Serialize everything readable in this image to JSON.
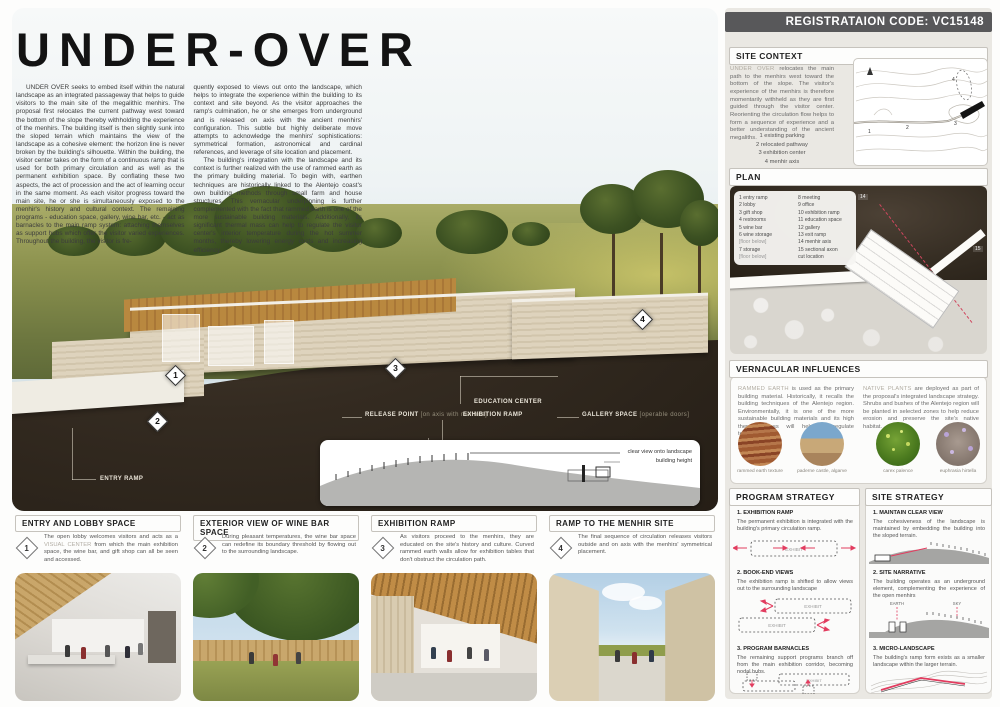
{
  "header": {
    "registration_code": "REGISTRATAION CODE: VC15148"
  },
  "title": "UNDER-OVER",
  "intro": {
    "col1": "UNDER OVER seeks to embed itself within the natural landscape as an integrated passageway that helps to guide visitors to the main site of the megalithic menhirs.  The proposal first relocates the current pathway west toward the bottom of the slope thereby withholding the experience of the menhirs.  The building itself is then slightly sunk into the sloped terrain which maintains the view of the landscape as a cohesive element: the horizon line is never broken by the building's silhouette.   Within the building, the visitor center takes on the form of a continuous ramp that is used for both primary circulation and as well as the permanent exhibition space.  By conflating these two aspects, the act of procession and the act of learning occur in the same moment.  As each visitor progress toward the main site, he or she is simultaneously exposed to the menhir's history and cultural context.  The remaining programs - education space, gallery, wine bar, etc. - act as barnacles to the main ramp system: attaching themselves as support hubs which offer the visitor varied experiences.   Throughout the building, the visitor is fre-",
    "col2_p1": "quently exposed to views out onto the landscape, which helps to integrate the experience within the building to its context and site beyond.   As the visitor approaches the ramp's culmination, he or she emerges from underground and is released on axis with the ancient menhirs' configuration.  This subtle but highly deliberate move attempts to acknowledge the menhirs' sophistications: symmetrical formation, astronomical and cardinal references, and leverage of site location and placement.",
    "col2_p2": "The building's integration with the landscape and its context is further realized with the use of rammed earth as the primary building material.  To begin with, earthen techniques are historically linked to the Alentejo coast's own building methods through small farm and house structures.  This vernacular underpinning is further complemented with the fact that rammed earth is one of the more sustainable building materials.  Additionally, its significant thermal mass can help to regulate the visitor center's interior temperature during the hot summer months, thereby lowering energy costs and increasing efficiency."
  },
  "render": {
    "markers": {
      "m1": "1",
      "m2": "2",
      "m3": "3",
      "m4": "4"
    },
    "callouts": {
      "entry_ramp": "ENTRY RAMP",
      "wine_bar": "WINE BAR AREA",
      "wine_bar_note": "[operable doors]",
      "storage": "STORAGE BELOW",
      "storage_note": "[wine and general]",
      "release_point": "RELEASE POINT",
      "release_point_note": "[on axis with menhirs]",
      "education_center": "EDUCATION CENTER",
      "exhibition_ramp": "EXHIBITION RAMP",
      "gallery": "GALLERY SPACE",
      "gallery_note": "[operable doors]"
    },
    "elevation": {
      "clear_view": "clear view onto landscape",
      "building_height": "building height"
    }
  },
  "sidebar": {
    "site_context": {
      "title": "SITE CONTEXT",
      "lead": "UNDER OVER",
      "text": " relocates the main path to the menhirs west toward the bottom of the slope.  The visitor's experience of the menhirs is therefore momentarily withheld as they are first guided through the visitor center.  Reorienting the circulation flow helps to form a sequence of experience and a better understanding of the ancient megaliths.",
      "legend": [
        "1  existing parking",
        "2  relocated pathway",
        "3  exhibition center",
        "4  menhir axis"
      ],
      "map_numbers": [
        "1",
        "2",
        "3",
        "4"
      ]
    },
    "plan": {
      "title": "PLAN",
      "legend_left": [
        "1  entry ramp",
        "2  lobby",
        "3  gift shop",
        "4  restrooms",
        "5  wine bar",
        "6  wine storage",
        "[floor below]",
        "7  storage",
        "[floor below]"
      ],
      "legend_right": [
        "8  meeting",
        "9  office",
        "10  exhibition ramp",
        "11  education space",
        "12  gallery",
        "13  exit ramp",
        "14  menhir axis",
        "15  sectional axon",
        "cut location"
      ],
      "m14": "14",
      "m15": "15"
    },
    "vernacular": {
      "title": "VERNACULAR INFLUENCES",
      "rammed_lead": "RAMMED EARTH",
      "rammed_text": " is used as the primary building material.  Historically, it recalls the building techniques of the Alentejo region.  Environmentally, it is one of the more sustainable building materials and its high thermal mass will help to regulate temperatures.",
      "native_lead": "NATIVE PLANTS",
      "native_text": " are deployed as part of the proposal's integrated landscape strategy.  Shrubs and bushes of the Alentejo region will be planted in selected zones to help reduce erosion and preserve the site's native habitat.",
      "captions": [
        "rammed earth texture",
        "paderne castle, algarve",
        "carex palence",
        "euphrasia hirtella"
      ]
    },
    "program_strategy": {
      "title": "PROGRAM STRATEGY",
      "exhibit_label": "EXHIBIT",
      "items": [
        {
          "num": "1.",
          "heading": "EXHIBITION RAMP",
          "text": "The permanent exhibition is integrated with the building's primary circulation ramp."
        },
        {
          "num": "2.",
          "heading": "BOOK-END VIEWS",
          "text": "The exhibition ramp is shifted to allow views out to the surrounding landscape"
        },
        {
          "num": "3.",
          "heading": "PROGRAM BARNACLES",
          "text": "The remaining support programs branch off from the main exhibition corridor, becoming nodal hubs."
        }
      ]
    },
    "site_strategy": {
      "title": "SITE STRATEGY",
      "earth_label": "EARTH",
      "sky_label": "SKY",
      "items": [
        {
          "num": "1.",
          "heading": "MAINTAIN CLEAR VIEW",
          "text": "The cohesiveness of the landscape is maintained by embedding the building into the sloped terrain."
        },
        {
          "num": "2.",
          "heading": "SITE NARRATIVE",
          "text": "The building operates as an underground element, complementing the experience of the open menhirs"
        },
        {
          "num": "3.",
          "heading": "MICRO-LANDSCAPE",
          "text": "The building's ramp form exists as a smaller landscape within the larger terrain."
        }
      ]
    }
  },
  "panels": [
    {
      "num": "1",
      "title": "ENTRY AND LOBBY SPACE",
      "text_pre": "The open lobby welcomes visitors and acts as a ",
      "text_em": "VISUAL CENTER",
      "text_post": " from which the main exhibition space, the wine bar, and gift shop can all be seen and accessed."
    },
    {
      "num": "2",
      "title": "EXTERIOR VIEW OF WINE BAR SPACE",
      "text": "During pleasant temperatures, the wine bar space can redefine its boundary threshold by flowing out to the surrounding landscape."
    },
    {
      "num": "3",
      "title": "EXHIBITION RAMP",
      "text": "As visitors proceed to the menhirs, they are educated on the site's history and culture.  Curved rammed earth walls allow for exhibition tables that don't obstruct the circulation path."
    },
    {
      "num": "4",
      "title": "RAMP TO THE MENHIR SITE",
      "text": "The final sequence of circulation releases visitors outside and on axis with the menhirs' symmetrical placement."
    }
  ],
  "colors": {
    "accent_red": "#e23c5f",
    "header_gray": "#58585a",
    "soil_brown": "#342b21"
  }
}
